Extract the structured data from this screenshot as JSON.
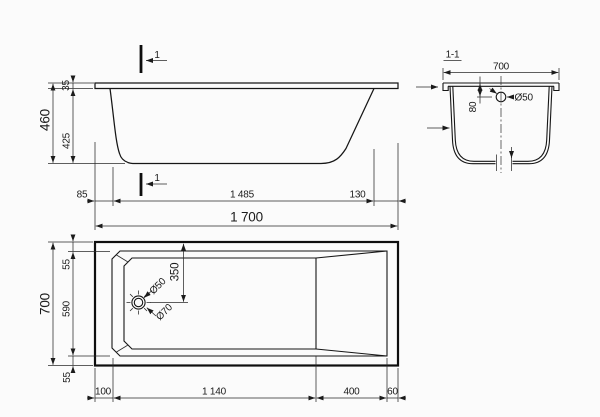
{
  "drawing": {
    "section_marker": "1",
    "side_view": {
      "overall_height": "460",
      "rim_thickness": "35",
      "depth": "425",
      "left_offset": "85",
      "bottom_length": "1 485",
      "slope_run": "130",
      "overall_length": "1 700"
    },
    "section_view": {
      "title": "1-1",
      "width": "700",
      "drain_offset_from_rim": "80",
      "drain_diameter": "Ø50"
    },
    "plan_view": {
      "overall_width": "700",
      "rim_top": "55",
      "inner_width": "590",
      "rim_bottom": "55",
      "drain_from_edge": "350",
      "drain_diameter_inner": "Ø50",
      "drain_diameter_outer": "Ø70",
      "left_offset": "100",
      "floor_length": "1 140",
      "slope_run": "400",
      "right_offset": "60"
    },
    "colors": {
      "line": "#1b1b1b",
      "background": "#fbfbfb"
    }
  }
}
